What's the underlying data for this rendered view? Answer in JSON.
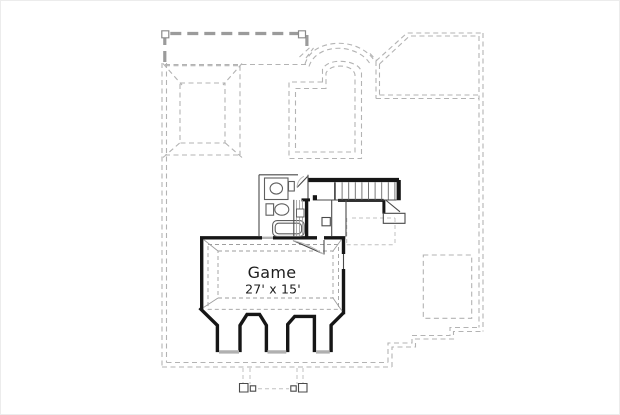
{
  "plan": {
    "kind": "floor-plan-drawing",
    "rooms": [
      {
        "name": "Game",
        "dimensions": "27' x 15'"
      }
    ],
    "elements": [
      "hip-roof-outline",
      "arched-roof-outline",
      "attic-dashed-outline",
      "staircase",
      "bathroom",
      "bay-windows",
      "porch-columns",
      "roof-footprint"
    ],
    "colors": {
      "wall": "#161616",
      "roof_dash": "#b3b3b3",
      "attic_dash": "#9b9b9b",
      "window_sill": "#b0b0b0",
      "fixture": "#5f5f5f"
    }
  }
}
